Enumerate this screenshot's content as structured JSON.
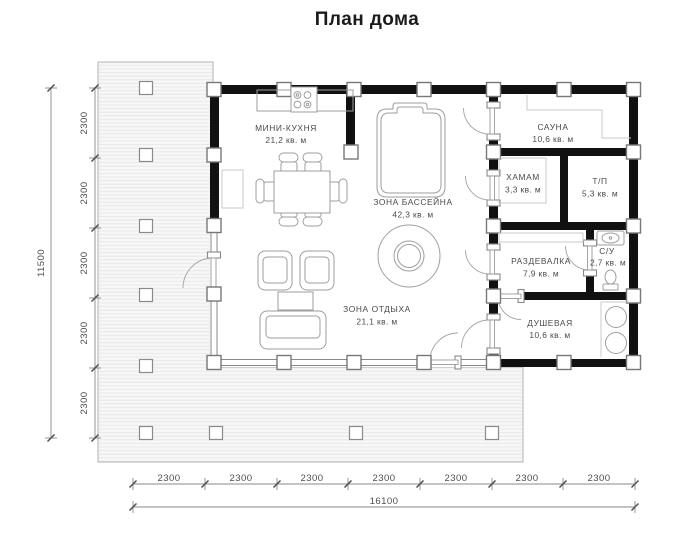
{
  "title": "План дома",
  "rooms": {
    "mini_kitchen": {
      "name": "МИНИ-КУХНЯ",
      "area": "21,2 кв. м"
    },
    "pool_zone": {
      "name": "ЗОНА БАССЕЙНА",
      "area": "42,3 кв. м"
    },
    "lounge_zone": {
      "name": "ЗОНА ОТДЫХА",
      "area": "21,1 кв. м"
    },
    "sauna": {
      "name": "САУНА",
      "area": "10,6 кв. м"
    },
    "hamam": {
      "name": "ХАМАМ",
      "area": "3,3 кв. м"
    },
    "tp": {
      "name": "Т/П",
      "area": "5,3 кв. м"
    },
    "dressing": {
      "name": "РАЗДЕВАЛКА",
      "area": "7,9 кв. м"
    },
    "wc": {
      "name": "С/У",
      "area": "2,7 кв. м"
    },
    "shower": {
      "name": "ДУШЕВАЯ",
      "area": "10,6 кв. м"
    }
  },
  "dimensions": {
    "bottom": {
      "segments": [
        "2300",
        "2300",
        "2300",
        "2300",
        "2300",
        "2300",
        "2300"
      ],
      "total": "16100"
    },
    "left": {
      "segments": [
        "2300",
        "2300",
        "2300",
        "2300",
        "2300"
      ],
      "total": "11500"
    }
  },
  "colors": {
    "wall": "#111111",
    "furniture_line": "#9e9e9e",
    "dim_line": "#8a8a8a",
    "deck_fill": "#f6f6f6"
  }
}
